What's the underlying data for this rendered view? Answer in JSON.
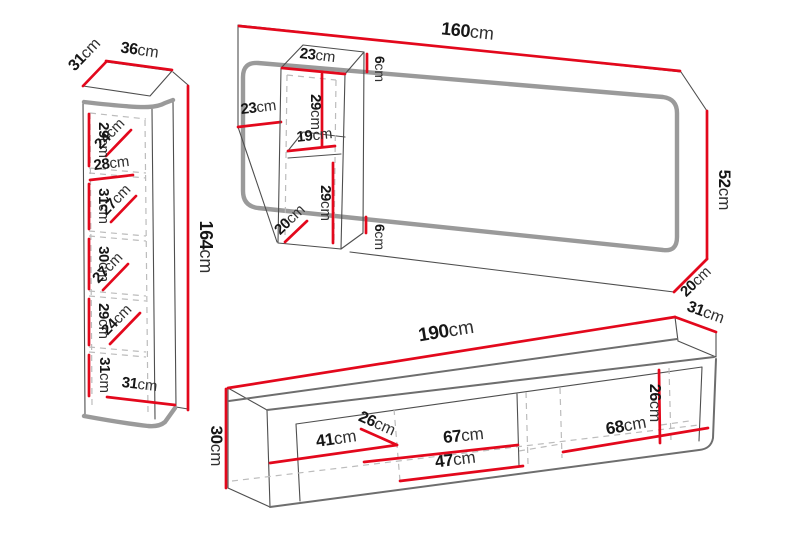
{
  "colors": {
    "dimension_line": "#e3081c",
    "outline_thin": "#4e4e4e",
    "outline_thick_gray": "#9a9a9a",
    "dashed": "#bcbcbc",
    "text": "#161616",
    "background": "#ffffff"
  },
  "pieces": {
    "tall_cabinet": {
      "name": "tall wall cabinet",
      "labels": [
        {
          "id": "top-depth",
          "num": "31",
          "unit": "cm"
        },
        {
          "id": "top-width",
          "num": "36",
          "unit": "cm"
        },
        {
          "id": "height",
          "num": "164",
          "unit": "cm"
        },
        {
          "id": "sec1-height",
          "num": "29",
          "unit": "cm"
        },
        {
          "id": "sec1-diag",
          "num": "24",
          "unit": "cm"
        },
        {
          "id": "shelf-width",
          "num": "28",
          "unit": "cm"
        },
        {
          "id": "sec2-height",
          "num": "31",
          "unit": "cm"
        },
        {
          "id": "sec2-diag",
          "num": "27",
          "unit": "cm"
        },
        {
          "id": "sec3-height",
          "num": "30",
          "unit": "cm"
        },
        {
          "id": "sec3-diag",
          "num": "27",
          "unit": "cm"
        },
        {
          "id": "sec4-height",
          "num": "29",
          "unit": "cm"
        },
        {
          "id": "sec4-diag",
          "num": "24",
          "unit": "cm"
        },
        {
          "id": "sec5-height",
          "num": "31",
          "unit": "cm"
        },
        {
          "id": "bottom-width",
          "num": "31",
          "unit": "cm"
        }
      ]
    },
    "wall_panel": {
      "name": "wall panel with small cabinet",
      "labels": [
        {
          "id": "panel-width",
          "num": "160",
          "unit": "cm"
        },
        {
          "id": "cabinet-top-width",
          "num": "23",
          "unit": "cm"
        },
        {
          "id": "gap-top",
          "num": "6",
          "unit": "cm"
        },
        {
          "id": "offset-left",
          "num": "23",
          "unit": "cm"
        },
        {
          "id": "upper-section",
          "num": "29",
          "unit": "cm"
        },
        {
          "id": "shelf-width",
          "num": "19",
          "unit": "cm"
        },
        {
          "id": "lower-section",
          "num": "29",
          "unit": "cm"
        },
        {
          "id": "cabinet-depth",
          "num": "20",
          "unit": "cm"
        },
        {
          "id": "gap-bottom",
          "num": "6",
          "unit": "cm"
        },
        {
          "id": "panel-height",
          "num": "52",
          "unit": "cm"
        },
        {
          "id": "panel-bottom-depth",
          "num": "20",
          "unit": "cm"
        }
      ]
    },
    "tv_stand": {
      "name": "tv stand",
      "labels": [
        {
          "id": "width",
          "num": "190",
          "unit": "cm"
        },
        {
          "id": "depth",
          "num": "31",
          "unit": "cm"
        },
        {
          "id": "height",
          "num": "30",
          "unit": "cm"
        },
        {
          "id": "left-compartment",
          "num": "41",
          "unit": "cm"
        },
        {
          "id": "mid-height",
          "num": "26",
          "unit": "cm"
        },
        {
          "id": "mid-compartment",
          "num": "67",
          "unit": "cm"
        },
        {
          "id": "front-width",
          "num": "47",
          "unit": "cm"
        },
        {
          "id": "right-height",
          "num": "26",
          "unit": "cm"
        },
        {
          "id": "right-compartment",
          "num": "68",
          "unit": "cm"
        }
      ]
    }
  }
}
